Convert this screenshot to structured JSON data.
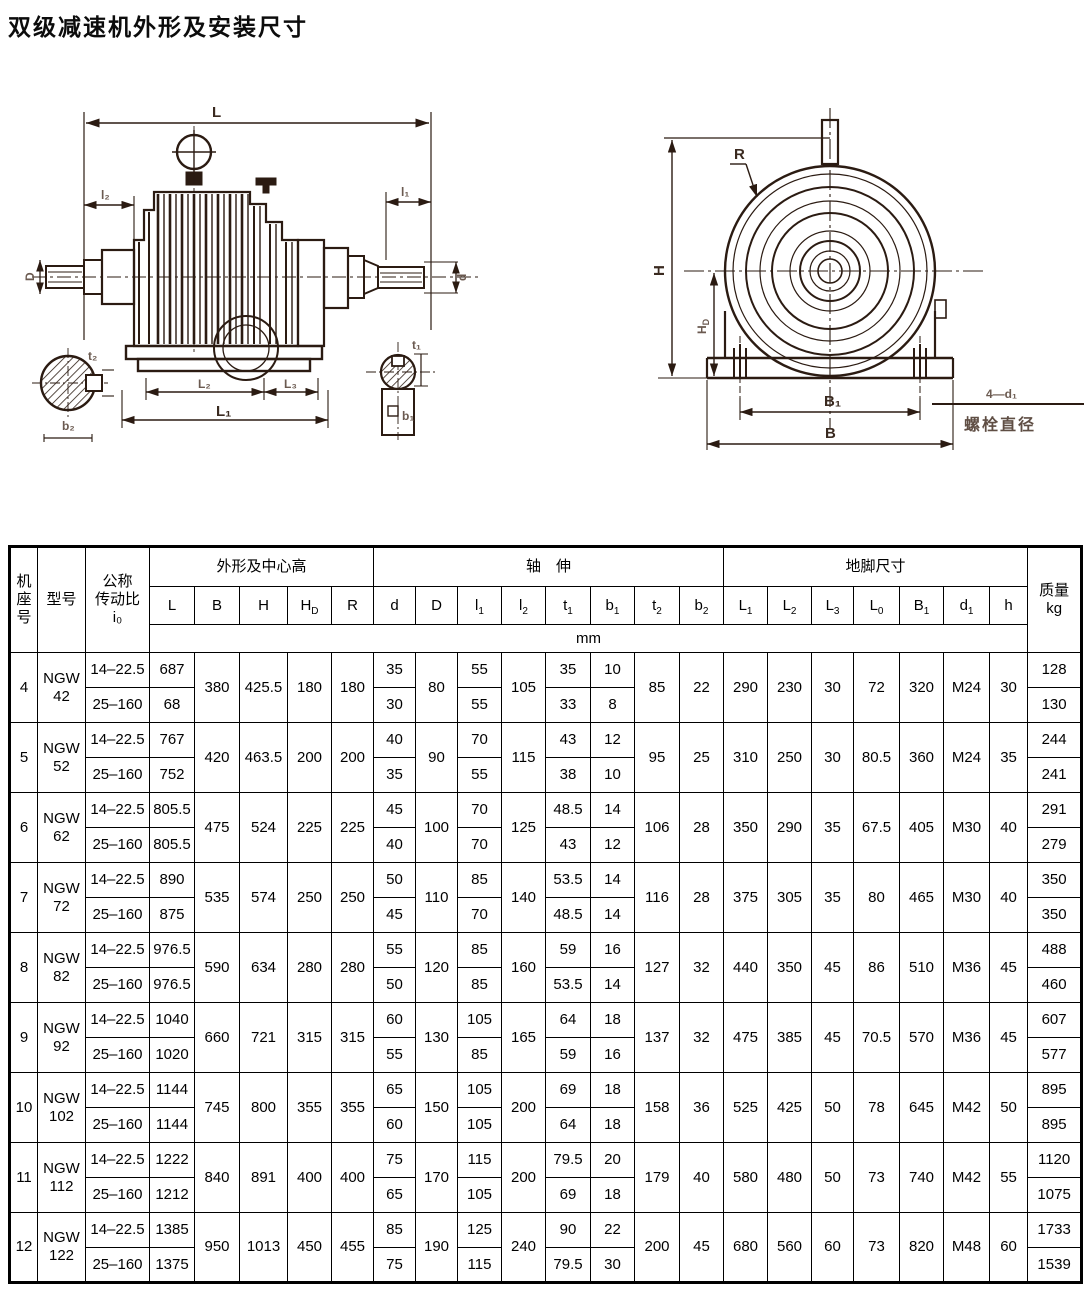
{
  "page_title": "双级减速机外形及安装尺寸",
  "drawings": {
    "left": {
      "labels": {
        "L": "L",
        "l2": "l₂",
        "l1": "l₁",
        "D": "D",
        "d": "d",
        "L1": "L₁",
        "L2": "L₂",
        "L3": "L₃",
        "t2": "t₂",
        "b2": "b₂",
        "t1": "t₁",
        "b1": "b₁"
      }
    },
    "right": {
      "labels": {
        "R": "R",
        "H": "H",
        "HD_main": "H",
        "HD_sub": "D",
        "B1": "B₁",
        "B": "B",
        "bolt_count": "4—d₁",
        "bolt_caption": "螺栓直径"
      }
    }
  },
  "table": {
    "headers": {
      "frame": "机\n座\n号",
      "model": "型号",
      "ratio": "公称\n传动比\ni₀",
      "outline": "外形及中心高",
      "shaft": "轴　伸",
      "foot": "地脚尺寸",
      "mass": "质量\nkg",
      "unit": "mm"
    },
    "columns": [
      {
        "t": "L"
      },
      {
        "t": "B"
      },
      {
        "t": "H"
      },
      {
        "t": "H",
        "s": "D"
      },
      {
        "t": "R"
      },
      {
        "t": "d"
      },
      {
        "t": "D"
      },
      {
        "t": "l",
        "s": "1"
      },
      {
        "t": "l",
        "s": "2"
      },
      {
        "t": "t",
        "s": "1"
      },
      {
        "t": "b",
        "s": "1"
      },
      {
        "t": "t",
        "s": "2"
      },
      {
        "t": "b",
        "s": "2"
      },
      {
        "t": "L",
        "s": "1"
      },
      {
        "t": "L",
        "s": "2"
      },
      {
        "t": "L",
        "s": "3"
      },
      {
        "t": "L",
        "s": "0"
      },
      {
        "t": "B",
        "s": "1"
      },
      {
        "t": "d",
        "s": "1"
      },
      {
        "t": "h"
      }
    ],
    "rows": [
      {
        "frame": "4",
        "model": "NGW\n42",
        "shared": {
          "B": "380",
          "H": "425.5",
          "HD": "180",
          "R": "180",
          "D": "80",
          "l2": "105",
          "t2": "85",
          "b2": "22",
          "L1": "290",
          "L2": "230",
          "L3": "30",
          "L0": "72",
          "B1": "320",
          "d1": "M24",
          "h": "30"
        },
        "sub": [
          {
            "ratio": "14–22.5",
            "L": "687",
            "d": "35",
            "l1": "55",
            "t1": "35",
            "b1": "10",
            "mass": "128"
          },
          {
            "ratio": "25–160",
            "L": "68",
            "d": "30",
            "l1": "55",
            "t1": "33",
            "b1": "8",
            "mass": "130"
          }
        ]
      },
      {
        "frame": "5",
        "model": "NGW\n52",
        "shared": {
          "B": "420",
          "H": "463.5",
          "HD": "200",
          "R": "200",
          "D": "90",
          "l2": "115",
          "t2": "95",
          "b2": "25",
          "L1": "310",
          "L2": "250",
          "L3": "30",
          "L0": "80.5",
          "B1": "360",
          "d1": "M24",
          "h": "35"
        },
        "sub": [
          {
            "ratio": "14–22.5",
            "L": "767",
            "d": "40",
            "l1": "70",
            "t1": "43",
            "b1": "12",
            "mass": "244"
          },
          {
            "ratio": "25–160",
            "L": "752",
            "d": "35",
            "l1": "55",
            "t1": "38",
            "b1": "10",
            "mass": "241"
          }
        ]
      },
      {
        "frame": "6",
        "model": "NGW\n62",
        "shared": {
          "B": "475",
          "H": "524",
          "HD": "225",
          "R": "225",
          "D": "100",
          "l2": "125",
          "t2": "106",
          "b2": "28",
          "L1": "350",
          "L2": "290",
          "L3": "35",
          "L0": "67.5",
          "B1": "405",
          "d1": "M30",
          "h": "40"
        },
        "sub": [
          {
            "ratio": "14–22.5",
            "L": "805.5",
            "d": "45",
            "l1": "70",
            "t1": "48.5",
            "b1": "14",
            "mass": "291"
          },
          {
            "ratio": "25–160",
            "L": "805.5",
            "d": "40",
            "l1": "70",
            "t1": "43",
            "b1": "12",
            "mass": "279"
          }
        ]
      },
      {
        "frame": "7",
        "model": "NGW\n72",
        "shared": {
          "B": "535",
          "H": "574",
          "HD": "250",
          "R": "250",
          "D": "110",
          "l2": "140",
          "t2": "116",
          "b2": "28",
          "L1": "375",
          "L2": "305",
          "L3": "35",
          "L0": "80",
          "B1": "465",
          "d1": "M30",
          "h": "40"
        },
        "sub": [
          {
            "ratio": "14–22.5",
            "L": "890",
            "d": "50",
            "l1": "85",
            "t1": "53.5",
            "b1": "14",
            "mass": "350"
          },
          {
            "ratio": "25–160",
            "L": "875",
            "d": "45",
            "l1": "70",
            "t1": "48.5",
            "b1": "14",
            "mass": "350"
          }
        ]
      },
      {
        "frame": "8",
        "model": "NGW\n82",
        "shared": {
          "B": "590",
          "H": "634",
          "HD": "280",
          "R": "280",
          "D": "120",
          "l2": "160",
          "t2": "127",
          "b2": "32",
          "L1": "440",
          "L2": "350",
          "L3": "45",
          "L0": "86",
          "B1": "510",
          "d1": "M36",
          "h": "45"
        },
        "sub": [
          {
            "ratio": "14–22.5",
            "L": "976.5",
            "d": "55",
            "l1": "85",
            "t1": "59",
            "b1": "16",
            "mass": "488"
          },
          {
            "ratio": "25–160",
            "L": "976.5",
            "d": "50",
            "l1": "85",
            "t1": "53.5",
            "b1": "14",
            "mass": "460"
          }
        ]
      },
      {
        "frame": "9",
        "model": "NGW\n92",
        "shared": {
          "B": "660",
          "H": "721",
          "HD": "315",
          "R": "315",
          "D": "130",
          "l2": "165",
          "t2": "137",
          "b2": "32",
          "L1": "475",
          "L2": "385",
          "L3": "45",
          "L0": "70.5",
          "B1": "570",
          "d1": "M36",
          "h": "45"
        },
        "sub": [
          {
            "ratio": "14–22.5",
            "L": "1040",
            "d": "60",
            "l1": "105",
            "t1": "64",
            "b1": "18",
            "mass": "607"
          },
          {
            "ratio": "25–160",
            "L": "1020",
            "d": "55",
            "l1": "85",
            "t1": "59",
            "b1": "16",
            "mass": "577"
          }
        ]
      },
      {
        "frame": "10",
        "model": "NGW\n102",
        "shared": {
          "B": "745",
          "H": "800",
          "HD": "355",
          "R": "355",
          "D": "150",
          "l2": "200",
          "t2": "158",
          "b2": "36",
          "L1": "525",
          "L2": "425",
          "L3": "50",
          "L0": "78",
          "B1": "645",
          "d1": "M42",
          "h": "50"
        },
        "sub": [
          {
            "ratio": "14–22.5",
            "L": "1144",
            "d": "65",
            "l1": "105",
            "t1": "69",
            "b1": "18",
            "mass": "895"
          },
          {
            "ratio": "25–160",
            "L": "1144",
            "d": "60",
            "l1": "105",
            "t1": "64",
            "b1": "18",
            "mass": "895"
          }
        ]
      },
      {
        "frame": "11",
        "model": "NGW\n112",
        "shared": {
          "B": "840",
          "H": "891",
          "HD": "400",
          "R": "400",
          "D": "170",
          "l2": "200",
          "t2": "179",
          "b2": "40",
          "L1": "580",
          "L2": "480",
          "L3": "50",
          "L0": "73",
          "B1": "740",
          "d1": "M42",
          "h": "55"
        },
        "sub": [
          {
            "ratio": "14–22.5",
            "L": "1222",
            "d": "75",
            "l1": "115",
            "t1": "79.5",
            "b1": "20",
            "mass": "1120"
          },
          {
            "ratio": "25–160",
            "L": "1212",
            "d": "65",
            "l1": "105",
            "t1": "69",
            "b1": "18",
            "mass": "1075"
          }
        ]
      },
      {
        "frame": "12",
        "model": "NGW\n122",
        "shared": {
          "B": "950",
          "H": "1013",
          "HD": "450",
          "R": "455",
          "D": "190",
          "l2": "240",
          "t2": "200",
          "b2": "45",
          "L1": "680",
          "L2": "560",
          "L3": "60",
          "L0": "73",
          "B1": "820",
          "d1": "M48",
          "h": "60"
        },
        "sub": [
          {
            "ratio": "14–22.5",
            "L": "1385",
            "d": "85",
            "l1": "125",
            "t1": "90",
            "b1": "22",
            "mass": "1733"
          },
          {
            "ratio": "25–160",
            "L": "1375",
            "d": "75",
            "l1": "115",
            "t1": "79.5",
            "b1": "30",
            "mass": "1539"
          }
        ]
      }
    ]
  }
}
